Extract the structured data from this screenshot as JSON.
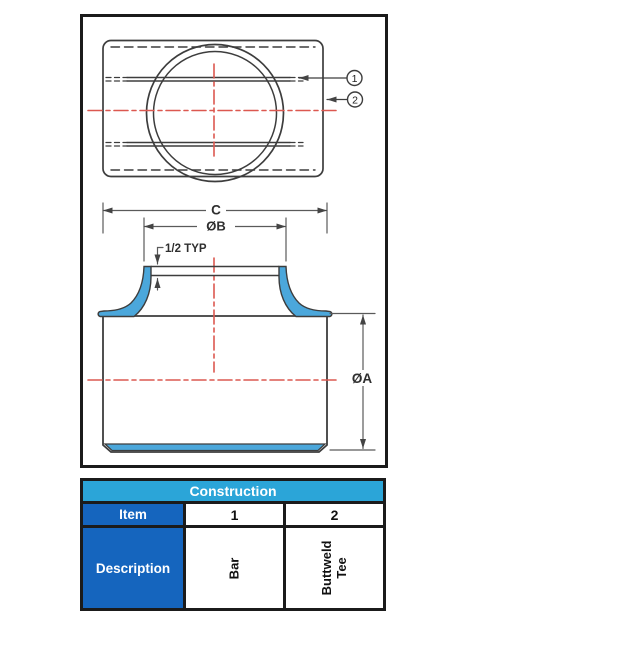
{
  "drawing": {
    "top_view": {
      "callouts": [
        {
          "label": "1",
          "points_to": "bar"
        },
        {
          "label": "2",
          "points_to": "buttweld-tee-body"
        }
      ]
    },
    "front_view": {
      "dim_c": "C",
      "dim_b": "ØB",
      "dim_typ": "1/2 TYP",
      "dim_a": "ØA"
    },
    "colors": {
      "weld_highlight": "#4ba7db",
      "centerline_red": "#dc5850",
      "outline": "#3d3d3d",
      "dimension": "#5a5a5a",
      "frame_border": "#1b1b1b"
    }
  },
  "table": {
    "title": "Construction",
    "item_header": "Item",
    "description_header": "Description",
    "header_bg": "#2ba5d8",
    "label_bg": "#1565be",
    "columns": [
      {
        "item": "1",
        "description": "Bar"
      },
      {
        "item": "2",
        "description": "Buttweld Tee"
      }
    ]
  }
}
